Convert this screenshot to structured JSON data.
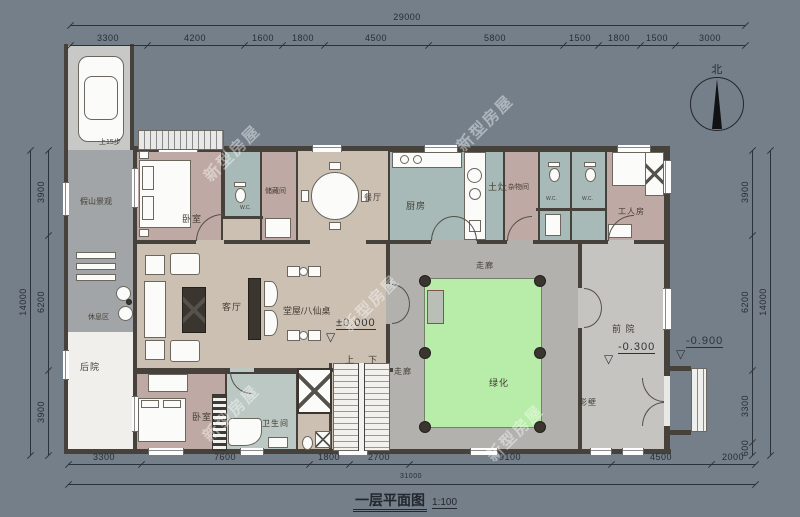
{
  "title": {
    "name": "一层平面图",
    "scale": "1:100"
  },
  "compass": {
    "label": "北"
  },
  "watermark": {
    "text": "新型房屋"
  },
  "dims": {
    "top": {
      "total": "29000",
      "segments": [
        "3300",
        "4200",
        "1600",
        "1800",
        "4500",
        "5800",
        "1500",
        "1800",
        "1500",
        "3000"
      ]
    },
    "bottom": {
      "total": "31000",
      "segments": [
        "3300",
        "7600",
        "1800",
        "2700",
        "9100",
        "4500",
        "2000"
      ]
    },
    "left": {
      "total": "14000",
      "segments": [
        "3900",
        "6200",
        "3900"
      ]
    },
    "right": {
      "total": "14000",
      "segments": [
        "3900",
        "6200",
        "3300",
        "600"
      ]
    }
  },
  "rooms": {
    "bedroom1": "卧室",
    "bedroom2": "卧室",
    "wc": "W.C.",
    "storage": "储藏间",
    "dining": "餐厅",
    "kitchen": "厨房",
    "stove": "土灶",
    "utility": "杂物间",
    "worker": "工人房",
    "living": "客厅",
    "hall": "堂屋/八仙桌",
    "corridor": "走廊",
    "green": "绿化",
    "front_yard": "前 院",
    "screen_wall": "影壁",
    "rockery": "假山景观",
    "rest": "休息区",
    "backyard": "后院",
    "bathroom": "卫生间"
  },
  "annotations": {
    "elev_zero": "±0.000",
    "elev_front": "-0.300",
    "elev_out": "-0.900",
    "level_symbol": "▽",
    "stair_up": "上",
    "stair_down": "下",
    "stair_entry": "上15步"
  },
  "colors": {
    "background": "#747f8a",
    "floor": "#ccc0b2",
    "bedroom": "#bfa9a4",
    "wet_room": "#a7bab7",
    "courtyard": "#b2b1ae",
    "green": "#b7eda8",
    "yard": "#c5c4c1",
    "wall": "#46413a",
    "backyard": "#f0efec"
  }
}
